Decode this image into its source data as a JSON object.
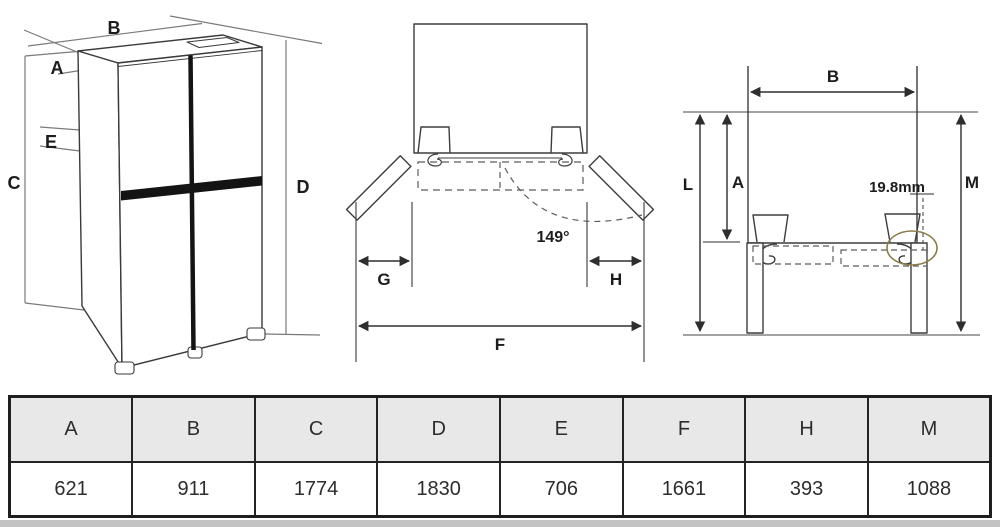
{
  "perspective_view": {
    "dim_a": "A",
    "dim_b": "B",
    "dim_c": "C",
    "dim_d": "D",
    "dim_e": "E"
  },
  "door_open_view": {
    "dim_g": "G",
    "dim_h": "H",
    "dim_f": "F",
    "opening_angle": "149°"
  },
  "clearance_view": {
    "dim_b": "B",
    "dim_l": "L",
    "dim_a": "A",
    "dim_m": "M",
    "hinge_offset": "19.8mm"
  },
  "colors": {
    "diagram_line": "#3a3a3a",
    "dimension_line": "#757575",
    "highlight_circle": "#8b7c49",
    "table_header_bg": "#e8e8e8",
    "table_border": "#242424"
  },
  "table": {
    "columns": [
      {
        "label": "A",
        "value": "621"
      },
      {
        "label": "B",
        "value": "911"
      },
      {
        "label": "C",
        "value": "1774"
      },
      {
        "label": "D",
        "value": "1830"
      },
      {
        "label": "E",
        "value": "706"
      },
      {
        "label": "F",
        "value": "1661"
      },
      {
        "label": "H",
        "value": "393"
      },
      {
        "label": "M",
        "value": "1088"
      }
    ]
  }
}
